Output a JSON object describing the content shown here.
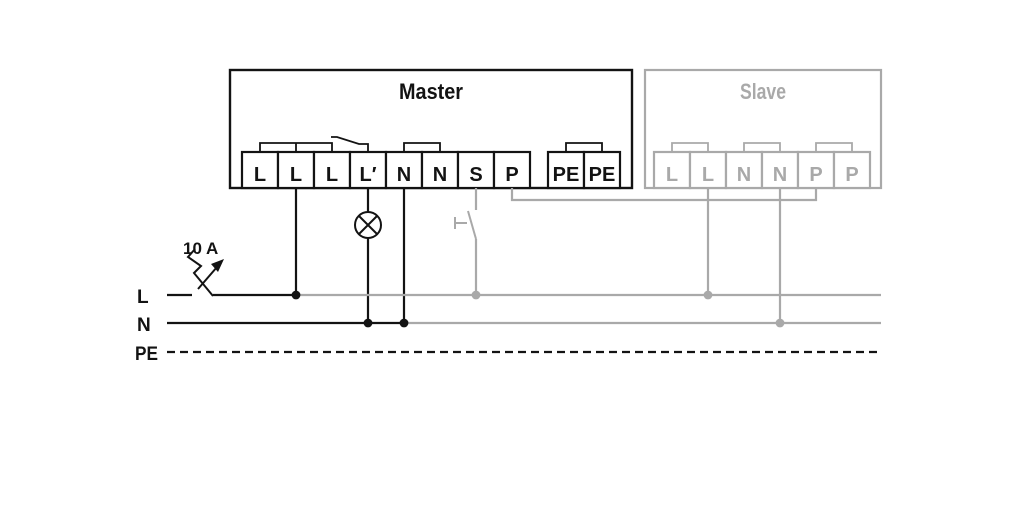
{
  "units": {
    "master": {
      "title": "Master",
      "terminals": [
        "L",
        "L",
        "L",
        "L′",
        "N",
        "N",
        "S",
        "P",
        "PE",
        "PE"
      ]
    },
    "slave": {
      "title": "Slave",
      "terminals": [
        "L",
        "L",
        "N",
        "N",
        "P",
        "P"
      ]
    }
  },
  "supply": {
    "bus_labels": [
      "L",
      "N",
      "PE"
    ],
    "breaker_rating": "10 A"
  },
  "icons": {
    "breaker": "circuit-breaker-icon",
    "lamp": "lamp-icon",
    "button": "push-button-icon",
    "relay": "relay-contact-icon"
  },
  "colors": {
    "active": "#131313",
    "inactive": "#a9a9a9",
    "background": "#ffffff"
  }
}
